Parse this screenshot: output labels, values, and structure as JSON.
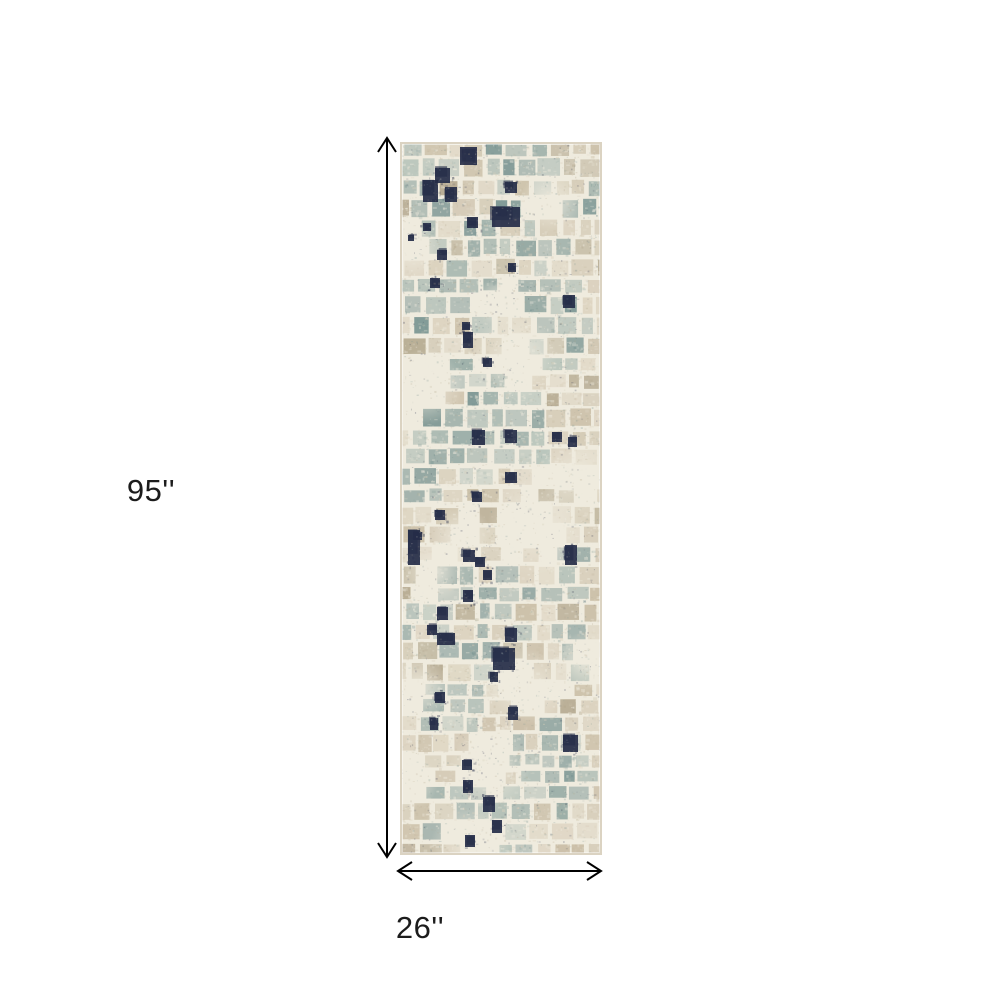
{
  "page": {
    "background": "#ffffff"
  },
  "diagram": {
    "type": "product-dimension-diagram",
    "height_label": "95''",
    "width_label": "26''",
    "height_value_inches": 95,
    "width_value_inches": 26,
    "arrow_color": "#000000",
    "label_color": "#1c1c1c",
    "rug": {
      "description": "abstract-distressed-runner-rug-image",
      "width_px": 202,
      "height_px": 713,
      "palette": {
        "cream": "#EFEBDE",
        "beige": "#C8BCA4",
        "beige_light": "#D9CFBB",
        "beige_dark": "#B2A68C",
        "slate": "#95A9A4",
        "slate_light": "#B2BFB7",
        "slate_dark": "#74908E",
        "navy": "#252C48",
        "border": "#DBD3C2"
      }
    }
  }
}
